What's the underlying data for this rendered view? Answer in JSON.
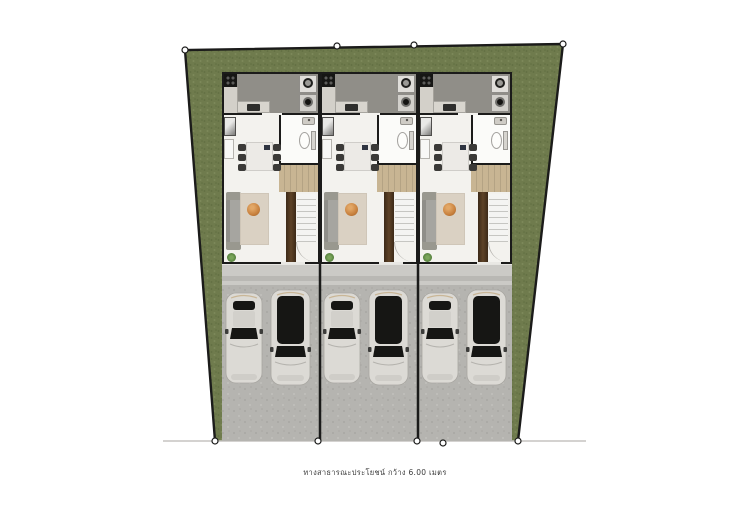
{
  "caption": {
    "text": "ทางสาธารณะประโยชน์ กว้าง 6.00 เมตร"
  },
  "site": {
    "units_count": 3,
    "cars_per_unit": 2
  },
  "palette": {
    "grass": "#6f7b4d",
    "grass_dark": "#616e41",
    "grass_light": "#7d895a",
    "concrete": "#b5b4b0",
    "concrete_dark": "#a8a7a3",
    "porch": "#cbcac6",
    "porch_band": "#b9b8b4",
    "road": "#c5c4c0",
    "wall": "#1b1b1a",
    "kitchen_floor": "#908e88",
    "living_floor": "#f3f2ee",
    "wood_dark": "#4a3420",
    "wood_light": "#c8b593",
    "rug": "#dad1c3",
    "pouf": "#c8813e",
    "car_body": "#dcdad5",
    "glass": "#161614",
    "plant": "#4f7a38"
  }
}
